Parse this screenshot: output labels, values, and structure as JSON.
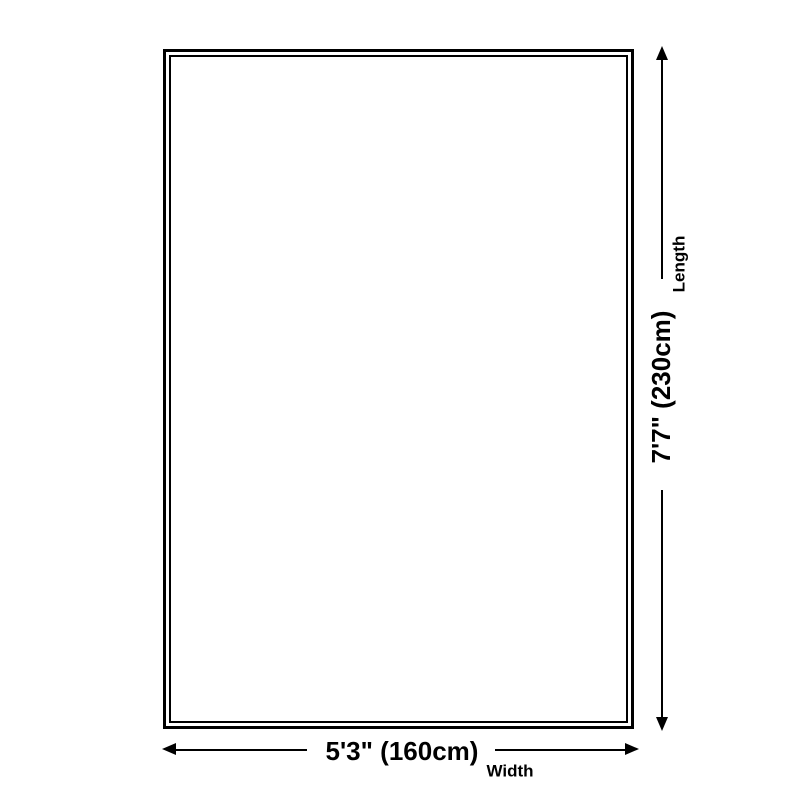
{
  "diagram": {
    "type": "product-dimension-diagram",
    "background_color": "#ffffff",
    "line_color": "#000000",
    "shape": "rectangle-double-border"
  },
  "dimensions": {
    "length": {
      "label": "Length",
      "value": "7'7\" (230cm)",
      "arrow_orientation": "vertical"
    },
    "width": {
      "label": "Width",
      "value": "5'3\" (160cm)",
      "arrow_orientation": "horizontal"
    }
  },
  "icons": {
    "arrow_up": "triangle-up",
    "arrow_down": "triangle-down",
    "arrow_left": "triangle-left",
    "arrow_right": "triangle-right"
  }
}
